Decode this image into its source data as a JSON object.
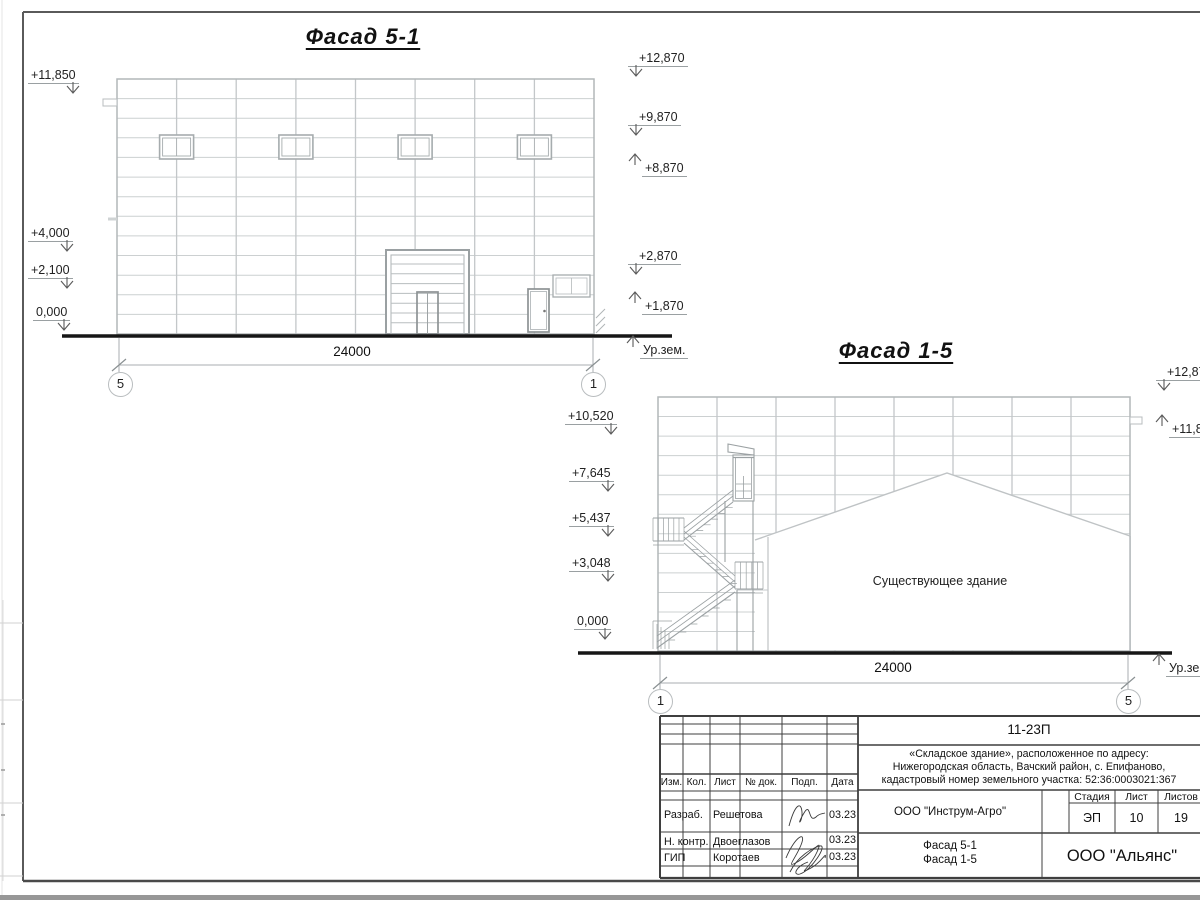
{
  "sheet": {
    "facade51": {
      "title": "Фасад 5-1",
      "dimension": "24000",
      "axis_left": "5",
      "axis_right": "1",
      "ground_label": "Ур.зем.",
      "marks_left": [
        "+11,850",
        "+4,000",
        "+2,100",
        "0,000"
      ],
      "marks_right_down": [
        "+12,870",
        "+9,870",
        "+2,870"
      ],
      "marks_right_up": [
        "+8,870",
        "+1,870"
      ]
    },
    "facade15": {
      "title": "Фасад 1-5",
      "dimension": "24000",
      "axis_left": "1",
      "axis_right": "5",
      "ground_label": "Ур.зем.",
      "existing_building_label": "Существующее здание",
      "marks_left": [
        "+10,520",
        "+7,645",
        "+5,437",
        "+3,048",
        "0,000"
      ],
      "marks_right_down": [
        "+12,870"
      ],
      "marks_right_up": [
        "+11,850"
      ]
    },
    "titleblock": {
      "doc_number": "11-23П",
      "project_line1": "«Складское здание», расположенное по адресу:",
      "project_line2": "Нижегородская область, Вачский район, с. Епифаново,",
      "project_line3": "кадастровый номер земельного участка: 52:36:0003021:367",
      "columns": {
        "izm": "Изм.",
        "kol": "Кол.",
        "list": "Лист",
        "doc": "№ док.",
        "podp": "Подп.",
        "data": "Дата"
      },
      "rows": [
        {
          "role": "Разраб.",
          "name": "Решетова",
          "date": "03.23"
        },
        {
          "role": "Н. контр.",
          "name": "Двоеглазов",
          "date": "03.23"
        },
        {
          "role": "ГИП",
          "name": "Коротаев",
          "date": "03.23"
        }
      ],
      "org": "ООО \"Инструм-Агро\"",
      "stage_label": "Стадия",
      "sheet_label": "Лист",
      "sheets_label": "Листов",
      "stage": "ЭП",
      "sheet_no": "10",
      "sheets_total": "19",
      "drawing_name1": "Фасад 5-1",
      "drawing_name2": "Фасад 1-5",
      "company": "ООО \"Альянс\""
    }
  }
}
